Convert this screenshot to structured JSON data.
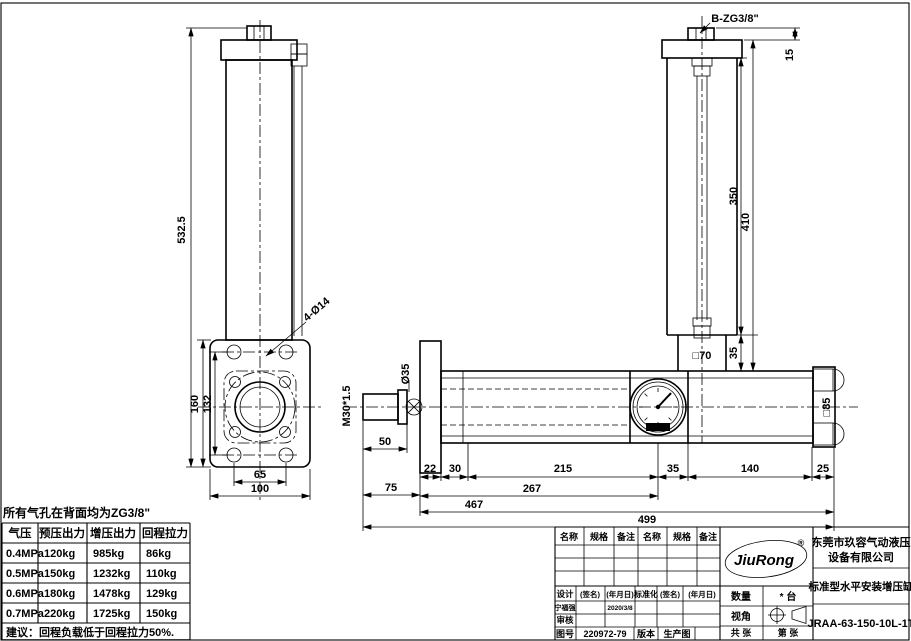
{
  "note": "所有气孔在背面均为ZG3/8\"",
  "force_table": {
    "headers": [
      "气压",
      "预压出力",
      "增压出力",
      "回程拉力"
    ],
    "rows": [
      [
        "0.4MPa",
        "120kg",
        "985kg",
        "86kg"
      ],
      [
        "0.5MPa",
        "150kg",
        "1232kg",
        "110kg"
      ],
      [
        "0.6MPa",
        "180kg",
        "1478kg",
        "129kg"
      ],
      [
        "0.7MPa",
        "220kg",
        "1725kg",
        "150kg"
      ]
    ],
    "footer": "建议：回程负载低于回程拉力50%."
  },
  "dims": {
    "d532": "532.5",
    "d160": "160",
    "d132": "132",
    "d65": "65",
    "d100": "100",
    "holes": "4-Ø14",
    "thread": "M30*1.5",
    "rod_dia": "Ø35",
    "d50": "50",
    "d75": "75",
    "c22": "22",
    "c30": "30",
    "c215": "215",
    "c35": "35",
    "c140": "140",
    "c25": "25",
    "d267": "267",
    "d467": "467",
    "d499": "499",
    "port": "B-ZG3/8\"",
    "d15": "15",
    "d350": "350",
    "d410": "410",
    "t35": "35",
    "sq70": "□70",
    "sq85": "□85"
  },
  "title_block": {
    "col_name": "名称",
    "col_spec": "规格",
    "col_note": "备注",
    "design": "设计",
    "sign": "(签名)",
    "date": "(年月日)",
    "standard": "标准化",
    "designer": "宁福强",
    "design_date": "2020/3/8",
    "audit": "审核",
    "drawing_no_label": "图号",
    "drawing_no": "220972-79",
    "version_label": "版本",
    "version": "生产图",
    "qty_label": "数量",
    "qty": "* 台",
    "view_label": "视角",
    "total_sheets": "共 张",
    "sheet_no": "第 张",
    "logo": "JiuRong",
    "reg": "®",
    "company_line1": "东莞市玖容气动液压",
    "company_line2": "设备有限公司",
    "product": "标准型水平安装增压缸",
    "model": "JRAA-63-150-10L-1T"
  }
}
